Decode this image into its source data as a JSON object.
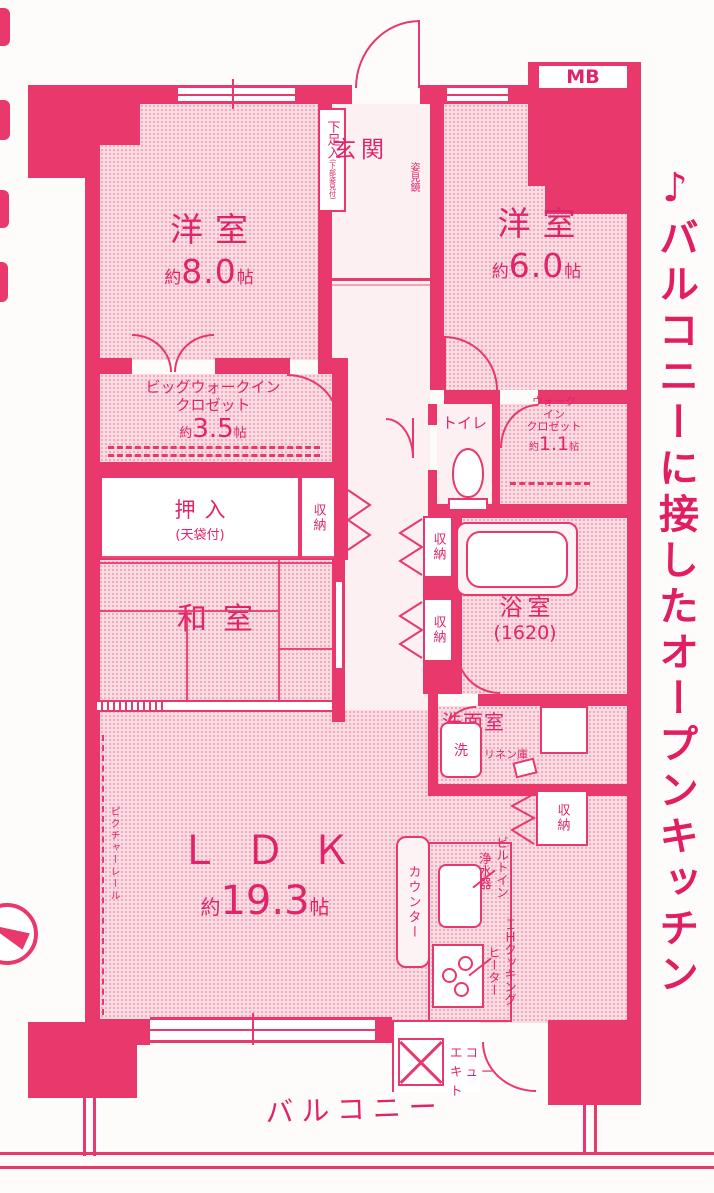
{
  "colors": {
    "wall": "#e8386c",
    "text": "#e0246a",
    "room_fill": "#fbdce2",
    "light_fill": "#fcf0f2"
  },
  "headline": "♪バルコニーに接したオープンキッチン",
  "rooms": {
    "bedroom8": {
      "name": "洋室",
      "approx": "約",
      "area": "8.0",
      "unit": "帖"
    },
    "bedroom6": {
      "name": "洋室",
      "approx": "約",
      "area": "6.0",
      "unit": "帖"
    },
    "ldk": {
      "name": "ＬＤＫ",
      "approx": "約",
      "area": "19.3",
      "unit": "帖"
    },
    "washitsu": {
      "name": "和室"
    },
    "genkan": {
      "name": "玄関"
    },
    "bath": {
      "name": "浴室",
      "size": "(1620)"
    },
    "washroom": {
      "name": "洗面室"
    },
    "toilet": {
      "name": "トイレ"
    },
    "big_wic": {
      "line1": "ビッグウォークイン",
      "line2": "クロゼット",
      "approx": "約",
      "area": "3.5",
      "unit": "帖"
    },
    "wic": {
      "line1": "ウォーク",
      "line2": "イン",
      "line3": "クロゼット",
      "approx": "約",
      "area": "1.1",
      "unit": "帖"
    },
    "oshiire": {
      "name": "押入",
      "note": "(天袋付)"
    }
  },
  "fixtures": {
    "shoe_cabinet": "下足入",
    "shoe_cabinet_note": "(下部姿見付)",
    "storage": "収納",
    "mirror": "姿見鏡",
    "washer": "洗",
    "linen": "リネン庫",
    "counter": "カウンター",
    "purifier_line1": "ビルトイン",
    "purifier_line2": "浄水器",
    "ih_line1": "ＩＨクッキング",
    "ih_line2": "ヒーター",
    "ecocute_line1": "エコ",
    "ecocute_line2": "キュート",
    "picture_rail": "ピクチャーレール",
    "mb": "MB",
    "balcony": "バルコニー"
  }
}
